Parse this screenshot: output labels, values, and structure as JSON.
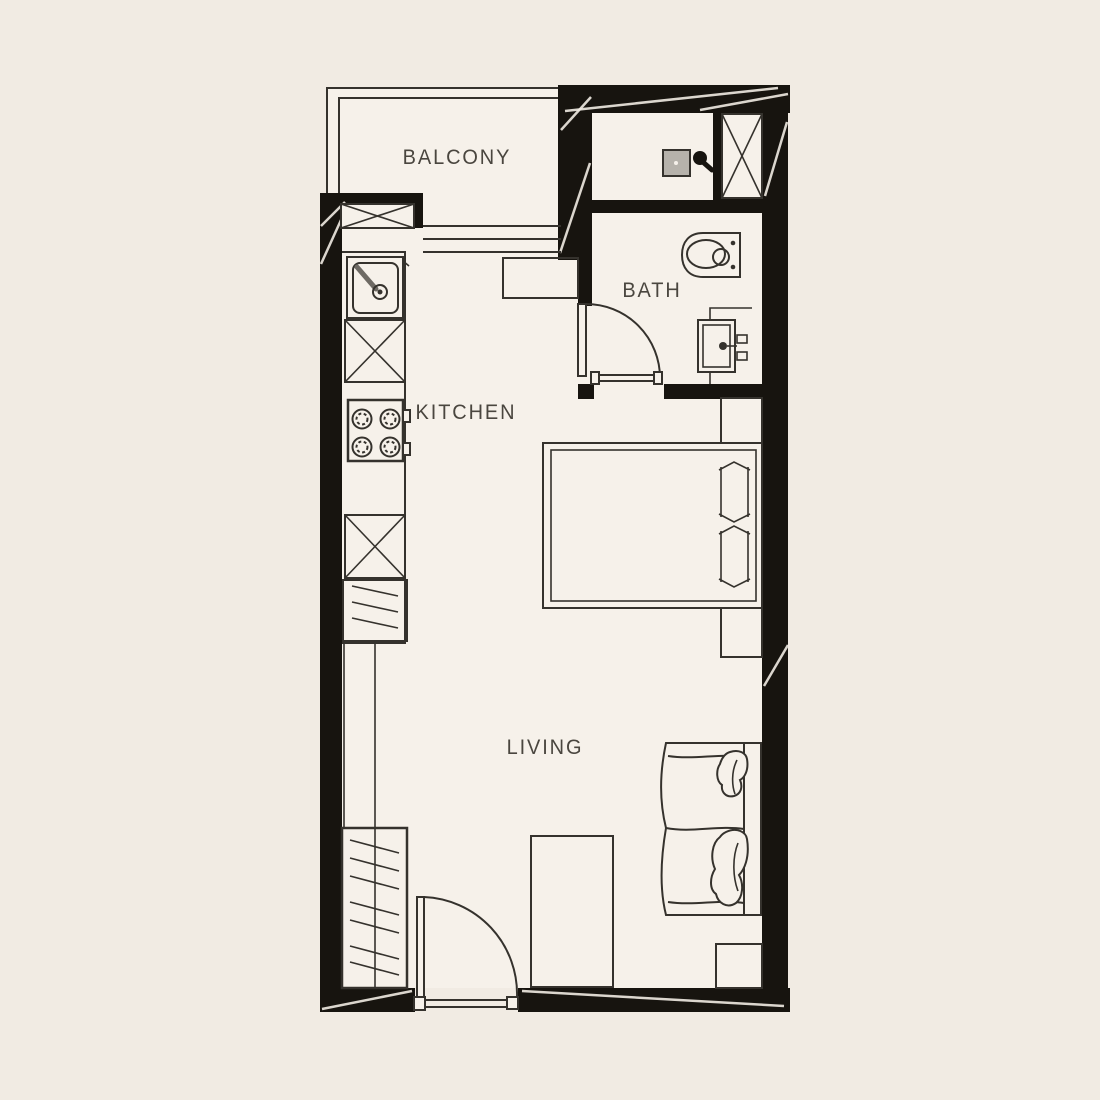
{
  "canvas": {
    "width": 1100,
    "height": 1100
  },
  "colors": {
    "page_background": "#f1ebe3",
    "floor": "#f6f1ea",
    "wall": "#17140f",
    "line": "#35322d",
    "label_text": "#4a463f",
    "drain_fill": "#b6b2ab",
    "faucet_steel": "#6e6a64"
  },
  "rooms": {
    "balcony": {
      "label": "BALCONY"
    },
    "bath": {
      "label": "BATH"
    },
    "kitchen": {
      "label": "KITCHEN"
    },
    "living": {
      "label": "LIVING"
    }
  },
  "fixtures": [
    "balcony-railing",
    "sliding-window",
    "wall-vent-x",
    "kitchen-sink",
    "base-cabinet-x",
    "cooktop-4-burner",
    "refrigerator",
    "kitchen-counter",
    "tall-cabinet-x",
    "wardrobe",
    "entry-door",
    "bath-door",
    "shower-area",
    "floor-drain",
    "shower-head",
    "service-shaft-x",
    "toilet",
    "vanity-basin",
    "double-bed",
    "pillows",
    "nightstand-upper",
    "nightstand-lower",
    "sofa",
    "throw-pillows",
    "study-table",
    "side-table"
  ]
}
